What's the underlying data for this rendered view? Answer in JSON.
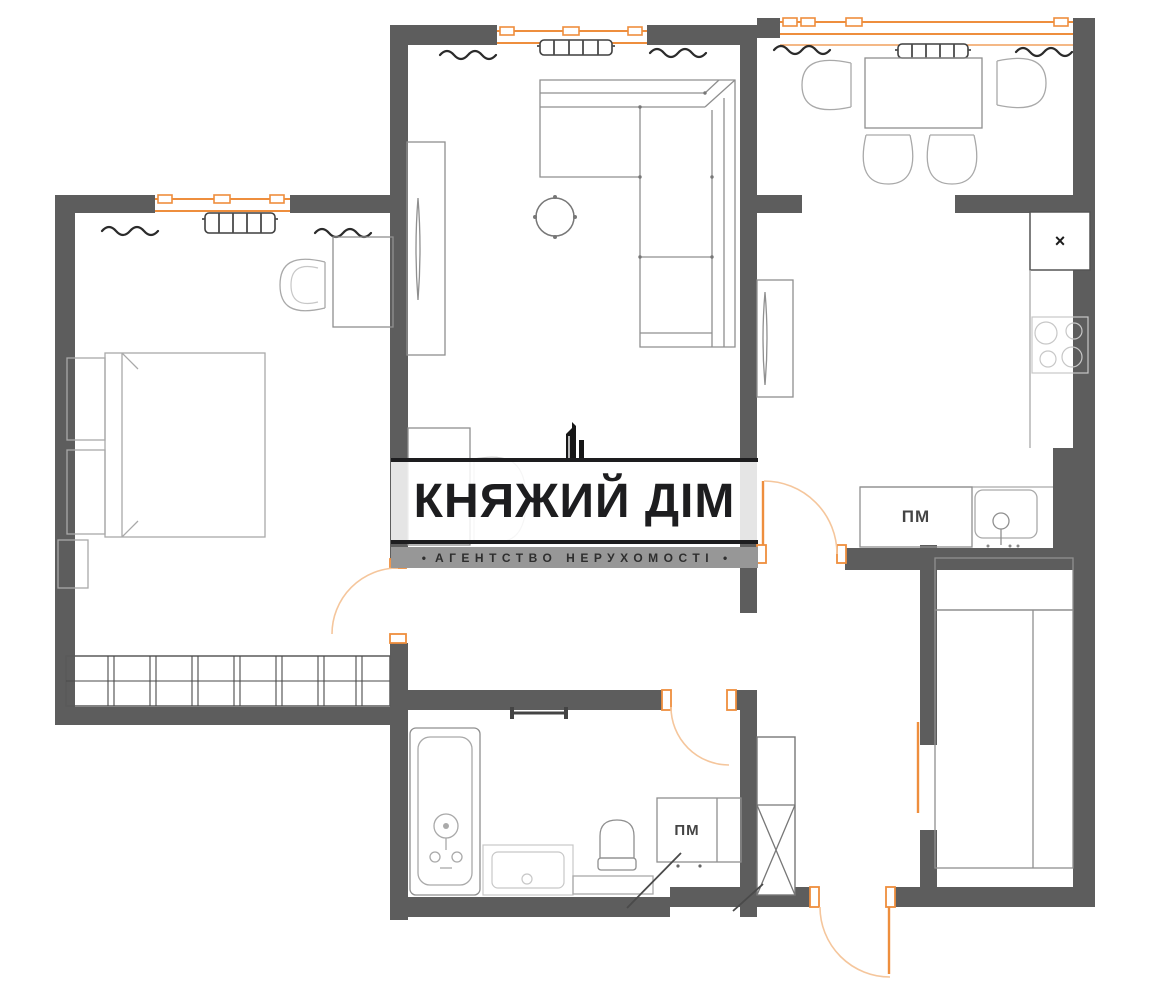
{
  "watermark": {
    "icon": "building-skyline",
    "title": "КНЯЖИЙ ДІМ",
    "subtitle": "АГЕНТСТВО НЕРУХОМОСТІ",
    "bullet": "•"
  },
  "labels": {
    "kitchen_washer": "ПМ",
    "bathroom_washer": "ПМ",
    "shaft_mark": "×"
  },
  "colors": {
    "background": "#ffffff",
    "wall": "#5d5d5d",
    "window_frame": "#ee8e3d",
    "door_swing": "#f5c69c",
    "furniture_stroke": "#a9a9a9",
    "dark_line": "#2b2b2b",
    "logo_text": "#1d1d1f",
    "logo_band": "#979797"
  }
}
